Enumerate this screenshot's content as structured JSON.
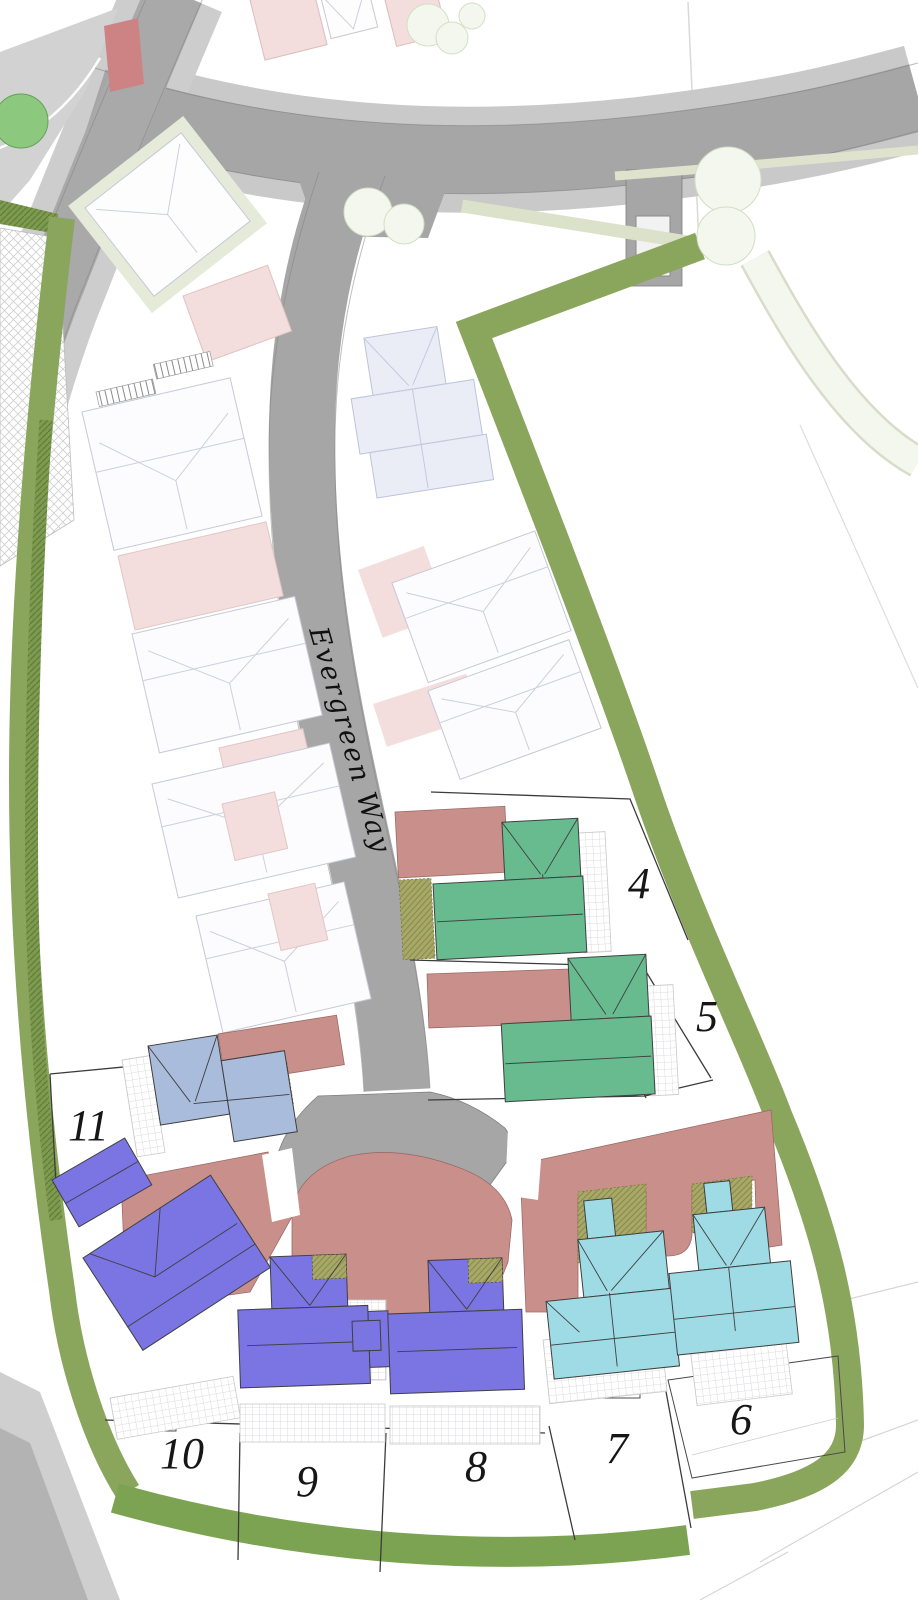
{
  "map": {
    "title": "Residential development site plan",
    "road_label": "Evergreen Way",
    "plots": [
      {
        "id": "plot-4",
        "number": "4"
      },
      {
        "id": "plot-5",
        "number": "5"
      },
      {
        "id": "plot-6",
        "number": "6"
      },
      {
        "id": "plot-7",
        "number": "7"
      },
      {
        "id": "plot-8",
        "number": "8"
      },
      {
        "id": "plot-9",
        "number": "9"
      },
      {
        "id": "plot-10",
        "number": "10"
      },
      {
        "id": "plot-11",
        "number": "11"
      }
    ],
    "colors": {
      "road": "#a6a6a6",
      "road_light": "#c9c9c9",
      "pavement": "#d2d2d2",
      "shared_drive_salmon": "#c9908b",
      "crossing_red": "#cd8383",
      "existing_building_pink": "#f3dddd",
      "proposed_house_green": "#67bb8e",
      "proposed_house_periwinkle": "#a9bcdb",
      "proposed_house_purple": "#7b74e3",
      "proposed_house_cyan": "#9edbe5",
      "hedge_green": "#8aa55c",
      "tree_green": "#8cc87d",
      "garden_hatch_olive": "#a8a967"
    }
  }
}
